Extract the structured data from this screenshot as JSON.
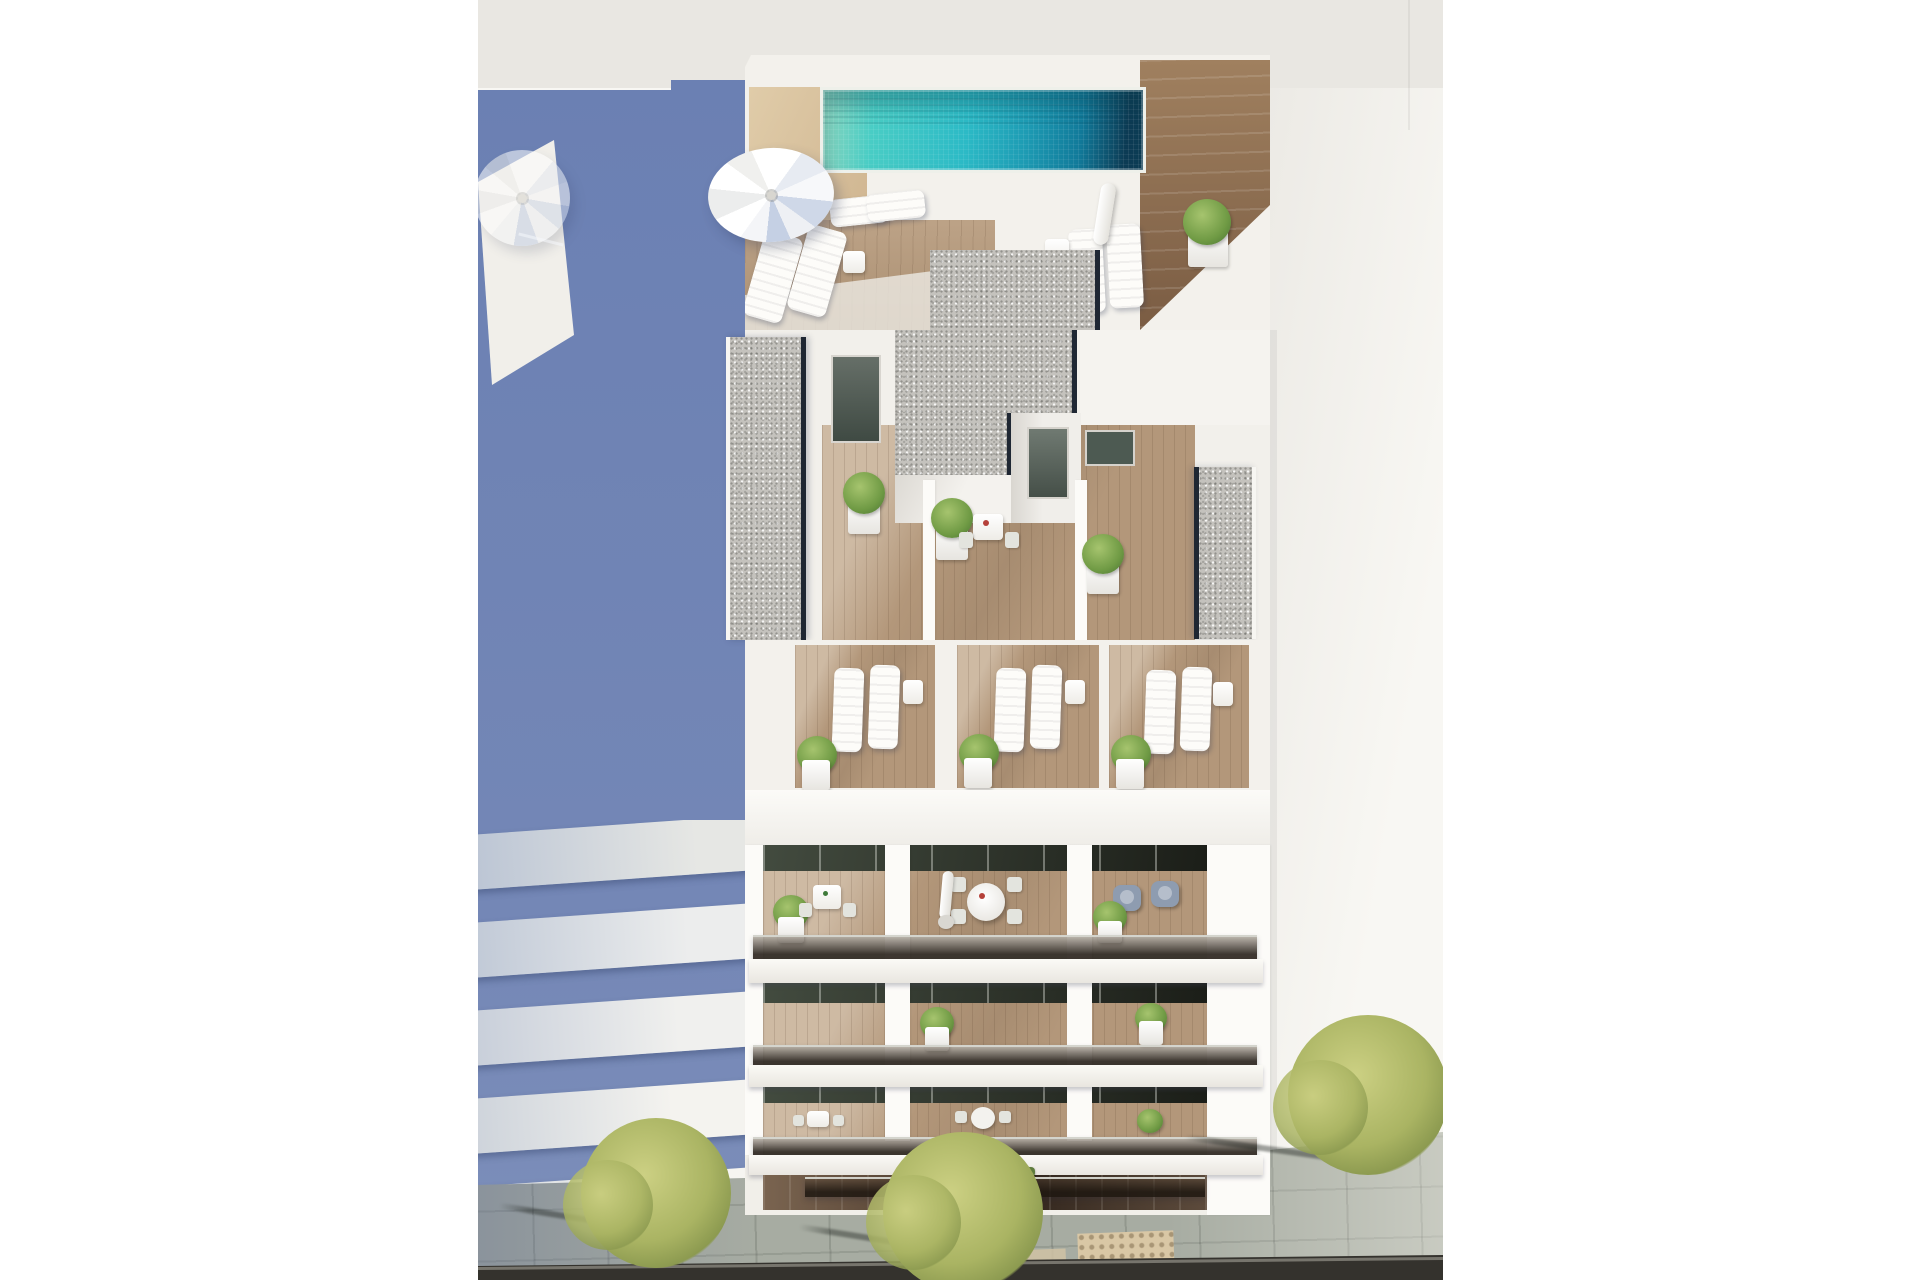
{
  "image": {
    "type": "photorealistic 3D architectural render",
    "view": "aerial bird's-eye view",
    "subject": "white modern apartment tower with rooftop pool, stepped terraces and glass balconies",
    "setting": "urban street, neighbouring white buildings, long blue-grey cast shadow on the left, tree-lined sidewalk below"
  },
  "palette": {
    "blue_shadow": "#6b80b3",
    "gray_band": "#e9e7e2",
    "roof_white": "#f8f7f3",
    "deck_white": "#f3f1ec",
    "wall_bright": "#fcfbf8",
    "wall_shade": "#e3e0da",
    "tan_wood": "#e0cca9",
    "walnut": "#8a6a4e",
    "deck_wood": "#b59879",
    "balcony_wood": "#b3977a",
    "gravel": "#c4c2bd",
    "navy_edge": "#1f2733",
    "pool_green": "#8ed6bf",
    "pool_light": "#49cdc5",
    "pool_mid": "#2cbac6",
    "pool_deep": "#117a9a",
    "pool_dark": "#0d3c55",
    "plant_green": "#6f9a44",
    "plant_light": "#a6c46e",
    "plant_dark": "#557f38",
    "pavement": "#a7aca2",
    "road": "#34322d",
    "tactile": "#d9c7a5",
    "tree_light": "#ccd083",
    "tree_mid": "#aab463",
    "tree_dark": "#8c9a50",
    "grate_dark": "#2e2b26",
    "furn_gray": "#8e9cb0",
    "hedge": "#5f7c3d",
    "door_glass": "#2a2e25",
    "umbrella_white": "#ffffff",
    "umbrella_blue_tint": "#c5d0e4"
  },
  "scene": {
    "rooftop": {
      "pool": "rectangular turquoise mosaic pool, dark deep end on the right",
      "open_umbrellas": 2,
      "closed_umbrellas": 1,
      "sun_loungers": 7,
      "gravel_roof_patches": 4,
      "deck_materials": [
        "light sand wood",
        "walnut plank walkway"
      ],
      "planters_with_shrubs": 2
    },
    "mid_level": {
      "terraces": 3,
      "dark_glass_doors": 3,
      "potted_shrubs": 3,
      "bistro_table_with_chairs": 1,
      "gravel_side_strips": 2
    },
    "lounger_level": {
      "bays": 3,
      "loungers_per_bay": 2,
      "side_tables": 3,
      "potted_shrubs": 3
    },
    "balcony_floors": [
      {
        "furniture": [
          "square table with two chairs",
          "round table with four chairs and folded parasol",
          "two blue-grey armchairs"
        ],
        "potted_plants": 2
      },
      {
        "furniture": [],
        "potted_plants": 2
      },
      {
        "furniture": [
          "small table and chair sets"
        ],
        "potted_plants": 2
      },
      {
        "furniture": [
          "hedge planter behind glass balustrade"
        ],
        "potted_plants": 1
      }
    ],
    "street": {
      "trees": 3,
      "tree_grates": "round concentric steel grates",
      "pavement": "large grey stone slabs",
      "tactile_paving_patches": 2,
      "road": "dark asphalt strip along bottom edge"
    },
    "neighbours": {
      "left": "balcony slab building in blue shade with ghost parasol",
      "right": "large flat white roof"
    }
  }
}
